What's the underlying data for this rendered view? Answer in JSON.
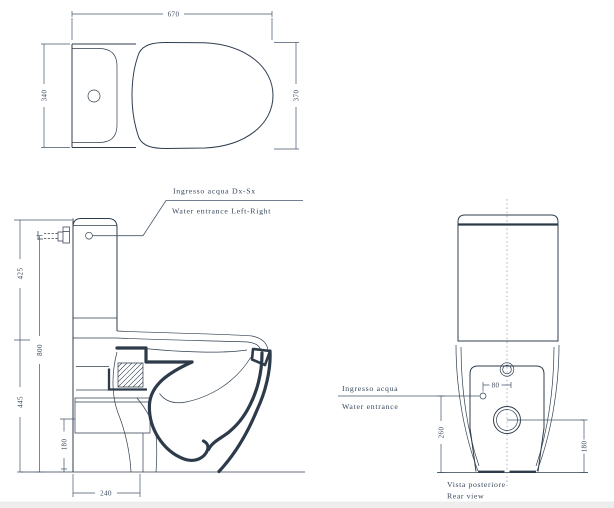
{
  "document": {
    "type": "technical-drawing",
    "subject": "Close-coupled one-piece WC, dimensioned orthographic views"
  },
  "colors": {
    "line": "#2f3e4e",
    "text": "#36465a",
    "background": "#ffffff",
    "centerline": "#96a3b0"
  },
  "top_view": {
    "dim_overall_length": "670",
    "dim_tank_width": "340",
    "dim_bowl_width": "370"
  },
  "side_view": {
    "dim_upper_height": "425",
    "dim_inlet_height": "800",
    "dim_lower_height": "445",
    "dim_outlet_height": "180",
    "dim_rear_clearance": "240",
    "inlet_note_it": "Ingresso acqua  Dx-Sx",
    "inlet_note_en": "Water entrance  Left-Right"
  },
  "rear_view": {
    "dim_inlet_offset": "80",
    "dim_inlet_height": "260",
    "dim_outlet_height": "180",
    "inlet_note_it": "Ingresso acqua",
    "inlet_note_en": "Water entrance",
    "caption_it": "Vista posteriore",
    "caption_en": "Rear view"
  }
}
